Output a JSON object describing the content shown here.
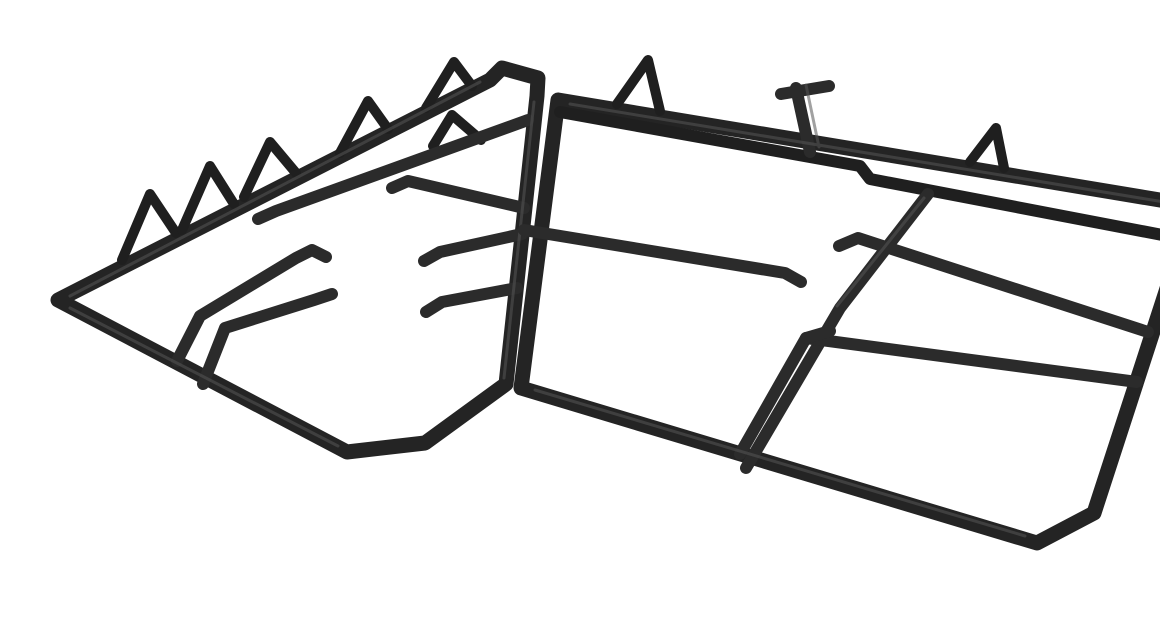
{
  "photo": {
    "subject": "Two black cast-iron pan support grates for a gas hob",
    "description": "Product photograph of a pair of matte black cast-iron pan stands shown side by side in perspective on a plain white background. Each grate is a rectangular outer frame with chamfered corners, long inner finger bars ending in small tabs, and triangular feet rising from the rear rails.",
    "colors": {
      "background": "#ffffff",
      "iron": "#242424",
      "iron_dark": "#1f1f1f",
      "iron_soft": "#2b2b2b",
      "sheen": "#565656"
    },
    "objects": [
      {
        "id": "left-pan-support",
        "label": "Left pan support grate",
        "rear_feet_count": 5,
        "inner_bar_feet_count": 1
      },
      {
        "id": "right-pan-support",
        "label": "Right pan support grate",
        "rear_feet_count": 2,
        "inner_bar_feet_count": 0
      }
    ]
  }
}
